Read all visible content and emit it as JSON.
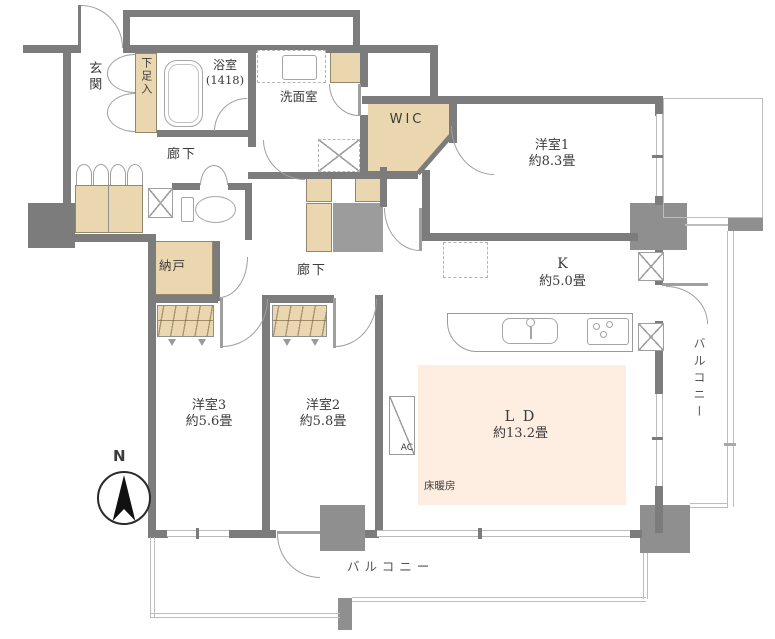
{
  "palette": {
    "wall": "#7c7c7c",
    "wall_light": "#bcbcbc",
    "beige": "#ead7b0",
    "peach": "#fdeee1",
    "pillar": "#8f8f8f",
    "utility": "#9c9c9c",
    "line": "#9f9f9f",
    "balcony_line": "#bdbdbd",
    "text": "#3b3b3b"
  },
  "compass": {
    "label": "N"
  },
  "rooms": {
    "genkan": {
      "label": "玄関"
    },
    "shoebox": {
      "label": "下足入"
    },
    "bath": {
      "label": "浴室",
      "size": "(1418)"
    },
    "washroom": {
      "label": "洗面室"
    },
    "wic": {
      "label": "WIC"
    },
    "hallway_upper": {
      "label": "廊下"
    },
    "hallway_mid": {
      "label": "廊下"
    },
    "storage": {
      "label": "納戸"
    },
    "bedroom1": {
      "label": "洋室1",
      "size": "約8.3畳"
    },
    "kitchen": {
      "label": "K",
      "size": "約5.0畳"
    },
    "living_dining": {
      "label": "L D",
      "size": "約13.2畳"
    },
    "bedroom2": {
      "label": "洋室2",
      "size": "約5.8畳"
    },
    "bedroom3": {
      "label": "洋室3",
      "size": "約5.6畳"
    }
  },
  "annotations": {
    "floor_heating": "床暖房",
    "ac_unit": "AC",
    "balcony_right": "バルコニー",
    "balcony_bottom": "バルコニー"
  }
}
